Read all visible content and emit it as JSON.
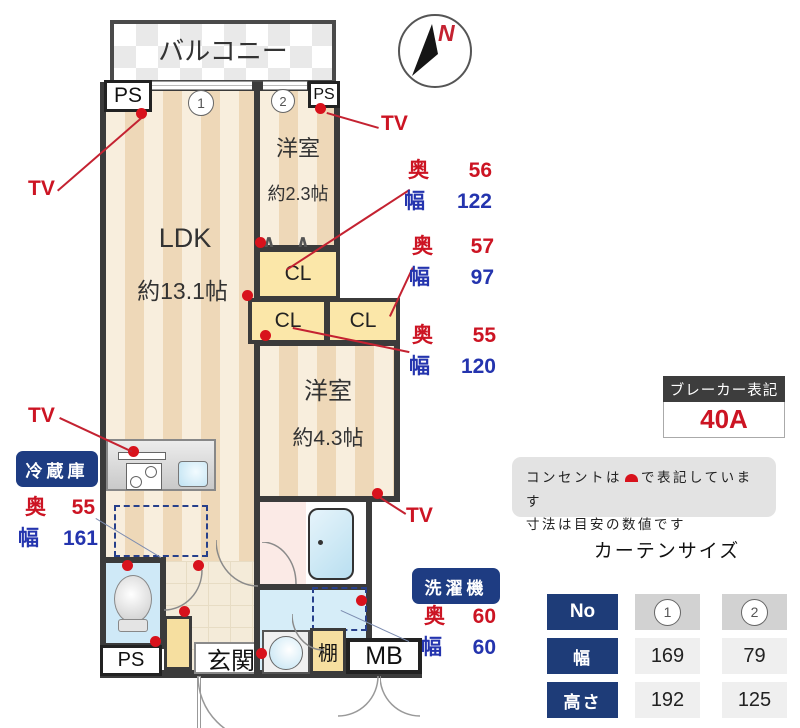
{
  "plan": {
    "balcony": "バルコニー",
    "north": "N",
    "ps": "PS",
    "mb": "MB",
    "genkan": "玄関",
    "shelf": "棚",
    "cl": "CL",
    "tv": "TV",
    "marker1": "1",
    "marker2": "2",
    "ldk": {
      "name": "LDK",
      "size": "約13.1帖"
    },
    "bedroom2": {
      "name": "洋室",
      "size": "約2.3帖"
    },
    "bedroom1": {
      "name": "洋室",
      "size": "約4.3帖"
    }
  },
  "icons": {
    "hanger_up": "∧",
    "hanger_down": "∨"
  },
  "measurements": {
    "closet_top": {
      "depth_label": "奥",
      "depth": "56",
      "width_label": "幅",
      "width": "122"
    },
    "closet_right": {
      "depth_label": "奥",
      "depth": "57",
      "width_label": "幅",
      "width": "97"
    },
    "closet_left": {
      "depth_label": "奥",
      "depth": "55",
      "width_label": "幅",
      "width": "120"
    },
    "fridge": {
      "title": "冷蔵庫",
      "depth_label": "奥",
      "depth": "55",
      "width_label": "幅",
      "width": "161"
    },
    "washer": {
      "title": "洗濯機",
      "depth_label": "奥",
      "depth": "60",
      "width_label": "幅",
      "width": "60"
    }
  },
  "breaker": {
    "title": "ブレーカー表記",
    "value": "40A"
  },
  "notes": {
    "line1_before": "コンセントは",
    "line1_after": "で表記しています",
    "line2": "寸法は目安の数値です"
  },
  "curtain": {
    "title": "カーテンサイズ",
    "rows": [
      {
        "header": "No",
        "c1": "1",
        "c2": "2"
      },
      {
        "header": "幅",
        "c1": "169",
        "c2": "79"
      },
      {
        "header": "高さ",
        "c1": "192",
        "c2": "125"
      }
    ]
  },
  "colors": {
    "accent_red": "#cc1423",
    "accent_blue": "#2434ae",
    "navy": "#1e3c82",
    "wall": "#3b3b3b"
  }
}
